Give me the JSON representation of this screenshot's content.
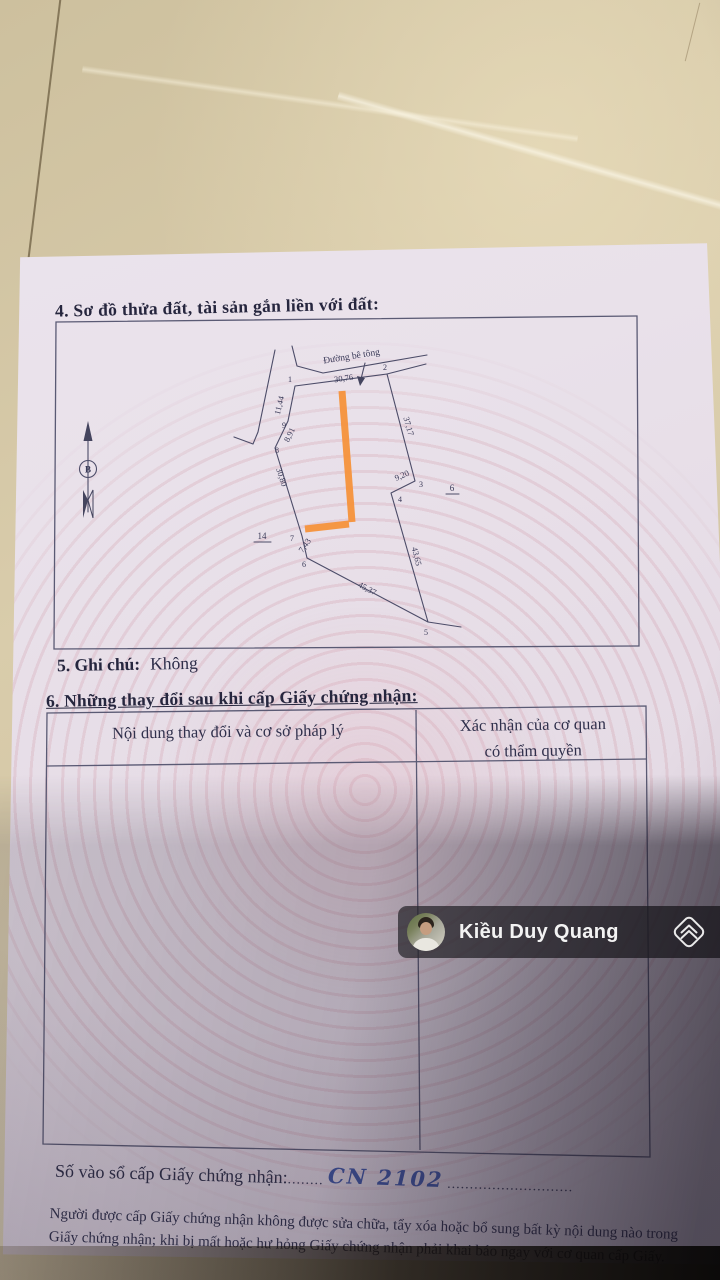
{
  "document": {
    "section4_title": "4. Sơ đồ thửa đất, tài sản gắn liền với đất:",
    "section5_label": "5. Ghi chú:",
    "section5_value": "Không",
    "section6_title": "6. Những thay đổi sau khi cấp Giấy chứng nhận:"
  },
  "diagram": {
    "road_label": "Đường bê tông",
    "north_symbol": "B",
    "vertices": [
      "1",
      "2",
      "3",
      "4",
      "5",
      "6",
      "7",
      "8",
      "9"
    ],
    "edge_lengths": [
      "30,76",
      "37,17",
      "9,20",
      "43,65",
      "45,37",
      "7,43",
      "30,80",
      "8,91",
      "11,44"
    ],
    "adjacent_plots": [
      "6",
      "14"
    ],
    "highlight_color": "#f5923b"
  },
  "table": {
    "col1_header": "Nội dung thay đổi và cơ sở pháp lý",
    "col2_header_line1": "Xác nhận của cơ quan",
    "col2_header_line2": "có thẩm quyền"
  },
  "watermark": {
    "name": "Kiều Duy Quang"
  },
  "footer": {
    "serial_label": "Số vào sổ cấp Giấy chứng nhận:",
    "dots_before": "........",
    "serial_value": "CN 2102",
    "dots_after": "............................",
    "note_line1": "Người được cấp Giấy chứng nhận không được sửa chữa, tẩy xóa hoặc bổ sung bất kỳ nội dung nào trong",
    "note_line2": "Giấy chứng nhận; khi bị mất hoặc hư hỏng Giấy chứng nhận phải khai báo ngay với cơ quan cấp Giấy."
  }
}
